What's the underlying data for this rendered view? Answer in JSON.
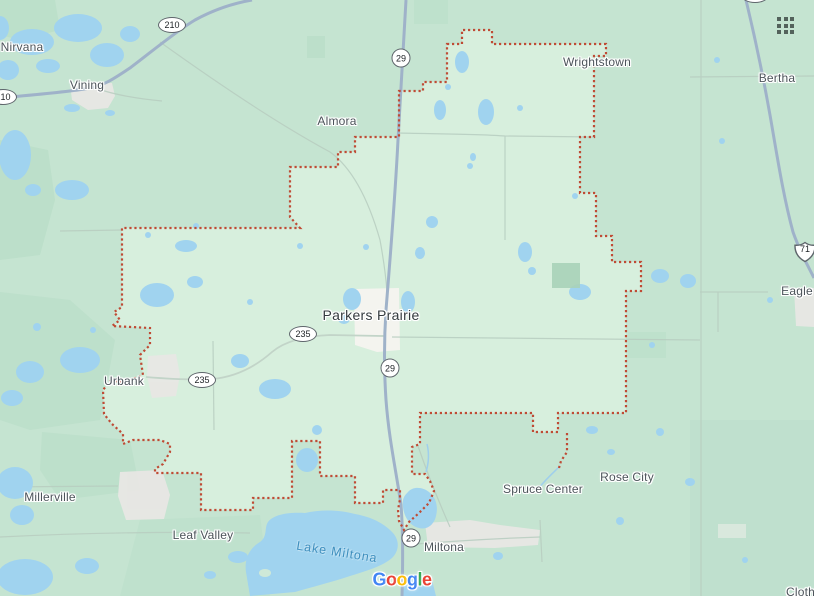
{
  "window": {
    "width": 814,
    "height": 596
  },
  "labels": {
    "nirvana": "Nirvana",
    "vining": "Vining",
    "almora": "Almora",
    "wrightstown": "Wrightstown",
    "bertha": "Bertha",
    "eagle": "Eagle",
    "urbank": "Urbank",
    "parkers_prairie": "Parkers Prairie",
    "millerville": "Millerville",
    "leaf_valley": "Leaf Valley",
    "spruce_center": "Spruce Center",
    "rose_city": "Rose City",
    "miltona": "Miltona",
    "clotho": "Clotho",
    "lake_miltona": "Lake Miltona"
  },
  "shields": {
    "route_210": "210",
    "route_29": "29",
    "route_235": "235",
    "route_71": "71"
  },
  "logo": {
    "letters": [
      {
        "char": "G",
        "color": "#4285F4"
      },
      {
        "char": "o",
        "color": "#EA4335"
      },
      {
        "char": "o",
        "color": "#FBBC05"
      },
      {
        "char": "g",
        "color": "#4285F4"
      },
      {
        "char": "l",
        "color": "#34A853"
      },
      {
        "char": "e",
        "color": "#EA4335"
      }
    ]
  },
  "colors": {
    "land": "#c5e4d1",
    "region_highlight": "#d7efdd",
    "water": "#a0d3ef",
    "boundary_dots": "#bf4b35",
    "highway": "#9fb2c9",
    "place_label": "#4c545a",
    "water_label": "#3f8fbe"
  }
}
